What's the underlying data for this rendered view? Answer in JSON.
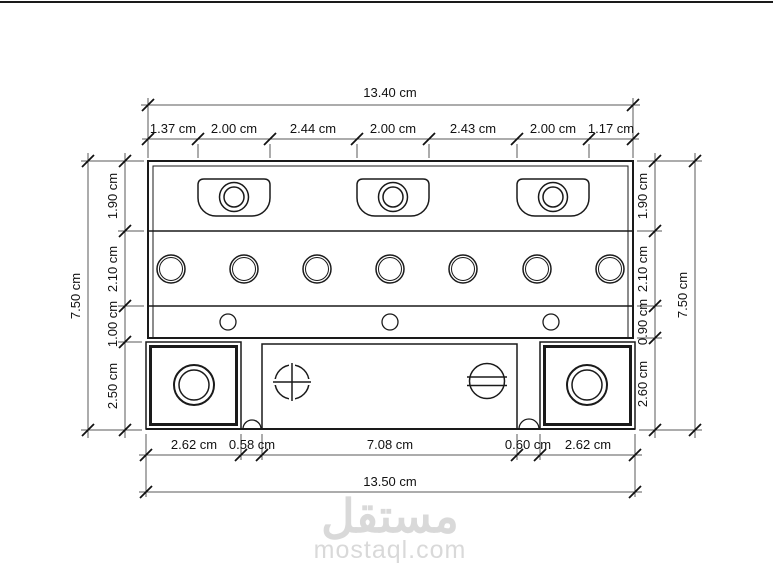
{
  "drawing": {
    "title": "battery-case-cross-section",
    "unit": "cm",
    "line_color": "#1a1a1a",
    "dim_color": "#5a5a5a",
    "watermark_color": "#d9d9d9"
  },
  "dimensions": {
    "top_overall": "13.40 cm",
    "top_segments": [
      "1.37 cm",
      "2.00 cm",
      "2.44 cm",
      "2.00 cm",
      "2.43 cm",
      "2.00 cm",
      "1.17 cm"
    ],
    "left_overall": "7.50 cm",
    "left_segments": [
      "1.90 cm",
      "2.10 cm",
      "1.00 cm",
      "2.50 cm"
    ],
    "right_segments": [
      "1.90 cm",
      "2.10 cm",
      "0.90 cm",
      "2.60 cm"
    ],
    "right_overall": "7.50 cm",
    "bottom_segments": [
      "2.62 cm",
      "0.58 cm",
      "7.08 cm",
      "0.60 cm",
      "2.62 cm"
    ],
    "bottom_overall": "13.50 cm"
  },
  "watermark": {
    "logo_text": "مستقل",
    "site_text": "mostaql.com"
  }
}
